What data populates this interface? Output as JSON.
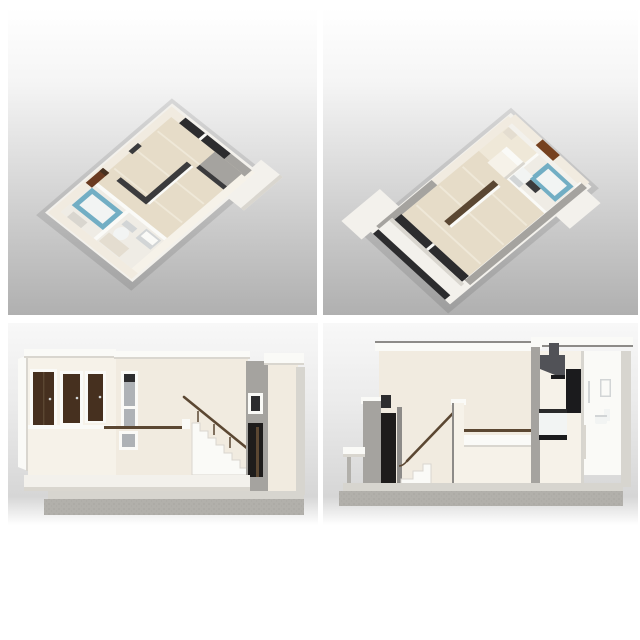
{
  "image_alt": "Four 3D architectural renders of a maisonette apartment: two isometric floor plans above, two cross-section elevations below",
  "panels": [
    {
      "label": "3D isometric floor plan, view from entrance and bathroom side"
    },
    {
      "label": "3D isometric floor plan, view from balcony side"
    },
    {
      "label": "Cross-section elevation with entry doors and descending staircase"
    },
    {
      "label": "Interior cross-section with staircase, kitchen and bathroom"
    }
  ],
  "palette": {
    "paper": "#ffffff",
    "backdrop_top_end": "#b0b0b0",
    "backdrop_bottom_start": "#f8f8f8",
    "backdrop_bottom_mid": "#d6d6d6",
    "slab_white": "#f3f1ec",
    "slab_shadow": "#d9d6cf",
    "wall_cream": "#f1ebe0",
    "wall_cream_light": "#f6f2e9",
    "wall_cream_dark": "#e4ddd0",
    "wall_gray": "#a5a39f",
    "wall_gray_dark": "#8d8b88",
    "wall_white": "#fafaf7",
    "floor_wood": "#e6dcc8",
    "floor_wood_light": "#efe8d8",
    "floor_pale": "#efece5",
    "glass_dark": "#2c2c2e",
    "glass_gray": "#aeb2b6",
    "door_dark_brown": "#46301f",
    "door_brown": "#76411f",
    "door_black": "#1e1c1b",
    "cabinet_brown": "#6a3a20",
    "rail_brown": "#5b4732",
    "teal": "#72aec4",
    "fixture_white": "#f2f4f3",
    "fixture_gray": "#d2d5d6",
    "dark_partition": "#3b3b3d",
    "hood_gray": "#515257",
    "appliance_black": "#1b1b1d",
    "counter_black": "#2a2a2a",
    "concrete": "#b2b0ab",
    "concrete_top": "#d7d5cf",
    "shadow": "rgba(0,0,0,0.10)"
  }
}
